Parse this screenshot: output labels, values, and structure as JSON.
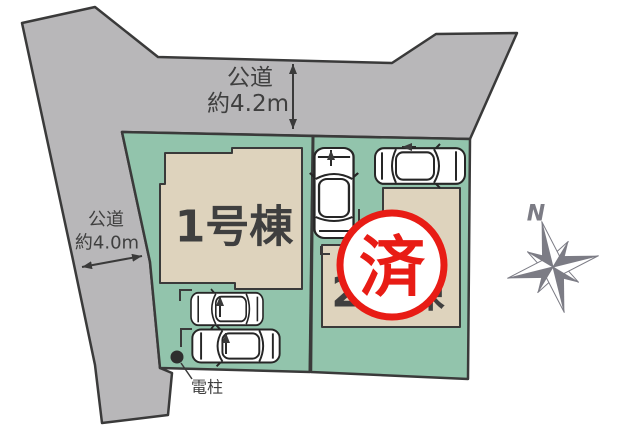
{
  "labels": {
    "road_top_name": "公道",
    "road_top_width": "約4.2m",
    "road_left_name": "公道",
    "road_left_width": "約4.0m",
    "building_1": "1号棟",
    "building_2": "2号棟",
    "sold_stamp": "済",
    "utility_pole": "電柱",
    "compass_north": "N"
  },
  "colors": {
    "road": "#b8b7b9",
    "plot": "#92c4ac",
    "building": "#ded3bd",
    "outline": "#3a3a3a",
    "stamp-red": "#e81c15",
    "compass-gray": "#7c7c85",
    "text-color": "#3f3f3f"
  }
}
